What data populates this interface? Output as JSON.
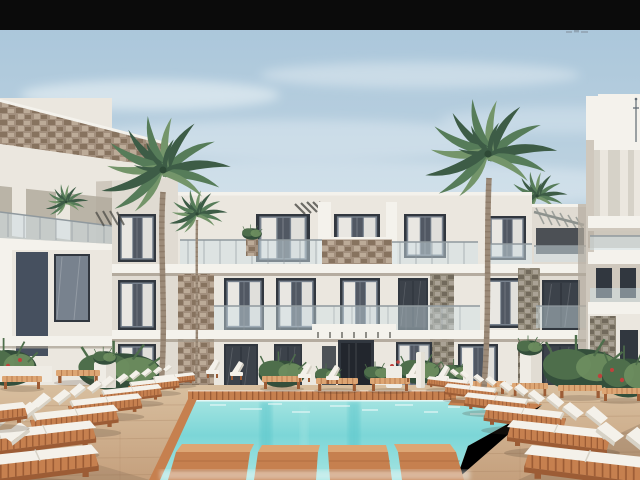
{
  "scene": {
    "description": "Architectural rendering of a modern white three-story resort apartment complex with two tall palm trees, a turquoise swimming pool with four wooden stepping platforms, sandy wooden deck and rows of white double sun loungers on orange-wood bases",
    "regions": {
      "letterbox": "black letterbox bar at top of frame",
      "sky": "pale blue sky with soft clouds",
      "watermark": "tiny illegible watermark artifact below the black bar",
      "center_building": "central three-story white apartment building with balconies, glass railings, stone accent panels and pergolas",
      "left_building": "left foreground building with sloped stone-clad parapet and dark navy accent panel",
      "right_building": "right foreground white building with stacked balcony slabs and rooftop antenna",
      "palm_left": "tall palm tree left of center",
      "palm_right": "tall palm tree right of center",
      "small_palms": "small palms by the facades",
      "pool": "turquoise swimming pool with wooden coping and stepping platforms",
      "deck": "sandy wooden pool deck",
      "loungers_left": "row of white double sun loungers on the left deck",
      "loungers_right": "row of white double sun loungers on the right deck",
      "far_furniture": "poolside chairs, slatted wooden benches, towel stands and planters across the pool",
      "plants": "green shrubs, potted plants and red flowering plants"
    },
    "counts": {
      "building_floors_center": 3,
      "large_palm_trees": 2,
      "small_palm_trees": 3,
      "stepping_platforms": 4,
      "loungers_left": 8,
      "loungers_right": 6
    },
    "watermark_text": ""
  },
  "palette": {
    "black_bar": "#0b0b0b",
    "sky_top": "#a8c5da",
    "sky_mid": "#c3d6e2",
    "sky_low": "#dfe9ee",
    "cloud": "#f0f5f8",
    "facade": "#ebe7df",
    "facade_bright": "#f4f2ec",
    "facade_mid": "#e0dbd2",
    "facade_shadow": "#cfc8bd",
    "facade_deep": "#b2aa9d",
    "slab_shadow": "#a79e90",
    "navy": "#46505f",
    "glass_dark": "#31373f",
    "glass_mid": "#78828e",
    "curtain": "#e9e7e2",
    "rail_glass": "#cfdfe6",
    "rail_frame": "#90999e",
    "pergola": "#4b4b46",
    "canopy": "#8d928e",
    "stone_warm": "#a28f7d",
    "stone_warm_dark": "#87735f",
    "stone_warm_light": "#bcab98",
    "stone_gray": "#908878",
    "stone_gray_dark": "#726a5c",
    "stone_gray_light": "#aaa295",
    "palm_dark": "#3d5c46",
    "palm_mid": "#567c59",
    "palm_light": "#74956a",
    "palm_core": "#2e4936",
    "trunk": "#9c8b79",
    "trunk_dark": "#7d6c5a",
    "deck_light": "#d8bf9f",
    "deck_mid": "#c5a07d",
    "deck_shadow": "#a5815f",
    "wood": "#c6804f",
    "wood_dark": "#9c5c35",
    "wood_light": "#dda674",
    "pool_pale": "#a5e4e1",
    "pool_main": "#7cd6d7",
    "pool_deep": "#58c5ca",
    "pool_glare": "#f4fbfa",
    "cushion": "#f4f1ea",
    "cushion_shadow": "#d7d2c6",
    "plant_dark": "#344f3b",
    "plant_mid": "#4e6e4b",
    "plant_light": "#6f8f60",
    "flower_red": "#c0403c",
    "pot_white": "#efece5",
    "ground_shadow": "#4a3a2c"
  }
}
